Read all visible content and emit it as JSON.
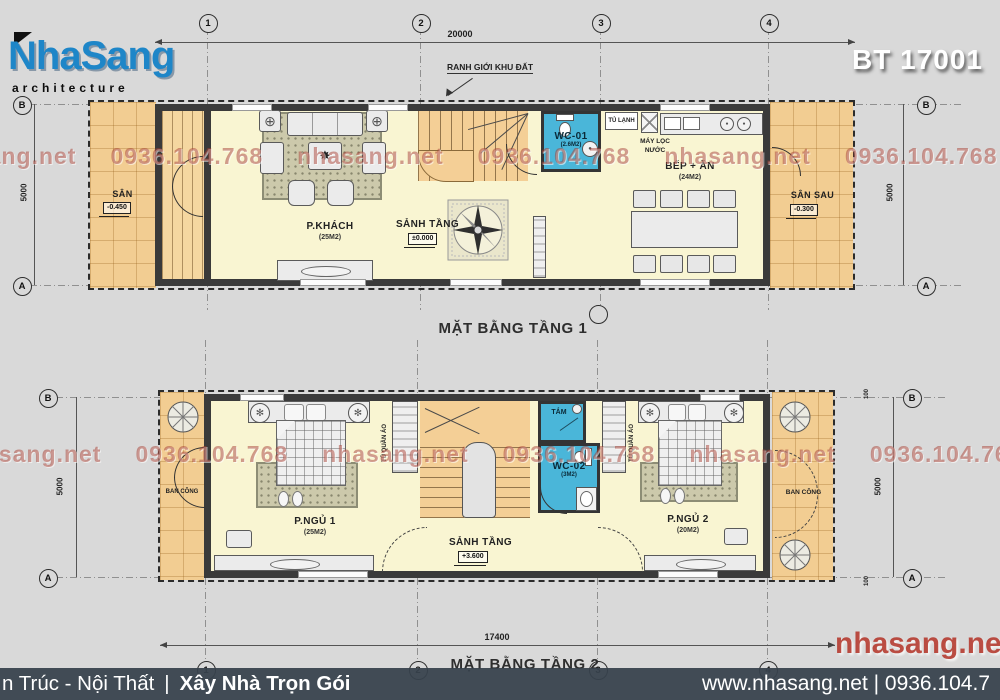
{
  "header": {
    "logo_title": "NhaSang",
    "logo_subtitle": "architecture",
    "project_code": "BT 17001"
  },
  "watermark": {
    "site": "nhasang.net",
    "phone": "0936.104.768",
    "big_site": "nhasang.net"
  },
  "floor1": {
    "title": "MẶT BẰNG TẦNG 1",
    "boundary_note": "RANH GIỚI KHU ĐẤT",
    "grid_cols": [
      "1",
      "2",
      "3",
      "4"
    ],
    "grid_row_top": "B",
    "grid_row_bottom": "A",
    "dims": {
      "width": "20000",
      "height": "5000"
    },
    "rooms": {
      "san": {
        "name": "SÂN",
        "level": "-0.450"
      },
      "khach": {
        "name": "P.KHÁCH",
        "area": "(25M2)"
      },
      "sanh": {
        "name": "SẢNH TẦNG",
        "level": "±0.000"
      },
      "wc": {
        "name": "WC-01",
        "area": "(2.6M2)"
      },
      "bep": {
        "name": "BẾP + ĂN",
        "area": "(24M2)"
      },
      "sansau": {
        "name": "SÂN SAU",
        "level": "-0.300"
      }
    },
    "labels": {
      "fridge": "TỦ LẠNH",
      "filter_line1": "MÁY LỌC",
      "filter_line2": "NƯỚC"
    }
  },
  "floor2": {
    "title": "MẶT BẰNG TẦNG 2",
    "grid_cols": [
      "1",
      "2",
      "3",
      "4"
    ],
    "grid_row_top": "B",
    "grid_row_bottom": "A",
    "dims": {
      "width": "17400",
      "height": "5000",
      "edge": "100"
    },
    "rooms": {
      "bancong_trai": {
        "name": "BAN CÔNG"
      },
      "ngu1": {
        "name": "P.NGỦ 1",
        "area": "(25M2)"
      },
      "sanh": {
        "name": "SẢNH TẦNG",
        "level": "+3.600"
      },
      "tam": {
        "name": "TẮM"
      },
      "wc": {
        "name": "WC-02",
        "area": "(3M2)"
      },
      "ngu2": {
        "name": "P.NGỦ 2",
        "area": "(20M2)"
      },
      "bancong_phai": {
        "name": "BAN CÔNG"
      }
    },
    "labels": {
      "wardrobe": "TỦ QUẦN ÁO"
    }
  },
  "footer": {
    "left_text": "n Trúc - Nội Thất",
    "divider": "|",
    "left_bold": "Xây Nhà Trọn Gói",
    "right_text": "www.nhasang.net | 0936.104.7"
  },
  "colors": {
    "logo_blue": "#1e86c8",
    "wc_blue": "#4ab6d9",
    "room_yellow": "#f9f5d2",
    "courtyard_orange": "#f2cd92",
    "footer_bg": "#37424c",
    "watermark_red": "#a53e32"
  }
}
